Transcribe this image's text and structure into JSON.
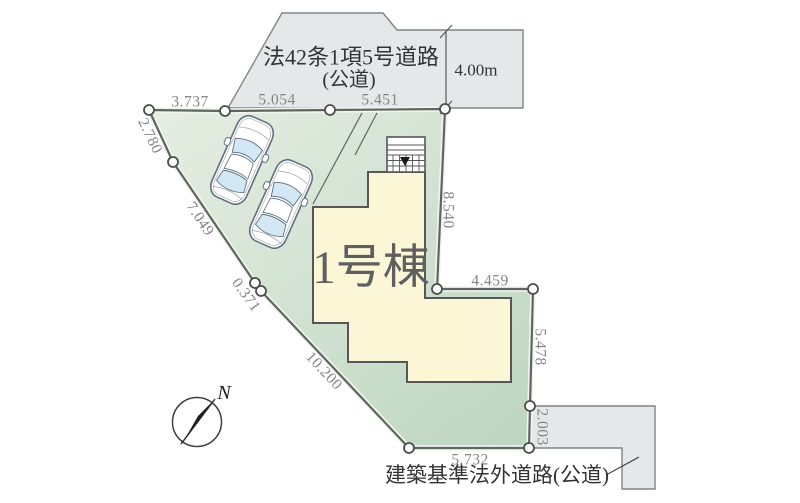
{
  "plan": {
    "building_label": "1号棟",
    "compass_label": "N",
    "top_road": {
      "name_line1": "法42条1項5号道路",
      "name_line2": "(公道)",
      "width_label": "4.00m"
    },
    "bottom_road": {
      "name": "建築基準法外道路(公道)"
    },
    "dims": {
      "edge_nw": "3.737",
      "edge_n1": "5.054",
      "edge_n2": "5.451",
      "edge_w1": "2.780",
      "edge_w2": "7.049",
      "edge_w3": "0.371",
      "edge_sw": "10.200",
      "edge_e1": "8.540",
      "edge_e2": "4.459",
      "edge_e3": "5.478",
      "edge_e4": "2.003",
      "edge_s": "5.732"
    }
  },
  "colors": {
    "lot_fill_light": "#e6eee2",
    "lot_fill_dark": "#bcd5c0",
    "lot_stroke": "#5e665f",
    "lot_inner_halo": "#f0f5ee",
    "road_fill": "#e4e8e9",
    "road_stroke": "#7e8588",
    "building_fill": "#fbf6d6",
    "building_stroke": "#57575a",
    "dim_text": "#858585",
    "road_text": "#333333",
    "building_text": "#5f5f5f",
    "car_window": "#d3e7f5",
    "car_stroke": "#5f6f7e"
  }
}
